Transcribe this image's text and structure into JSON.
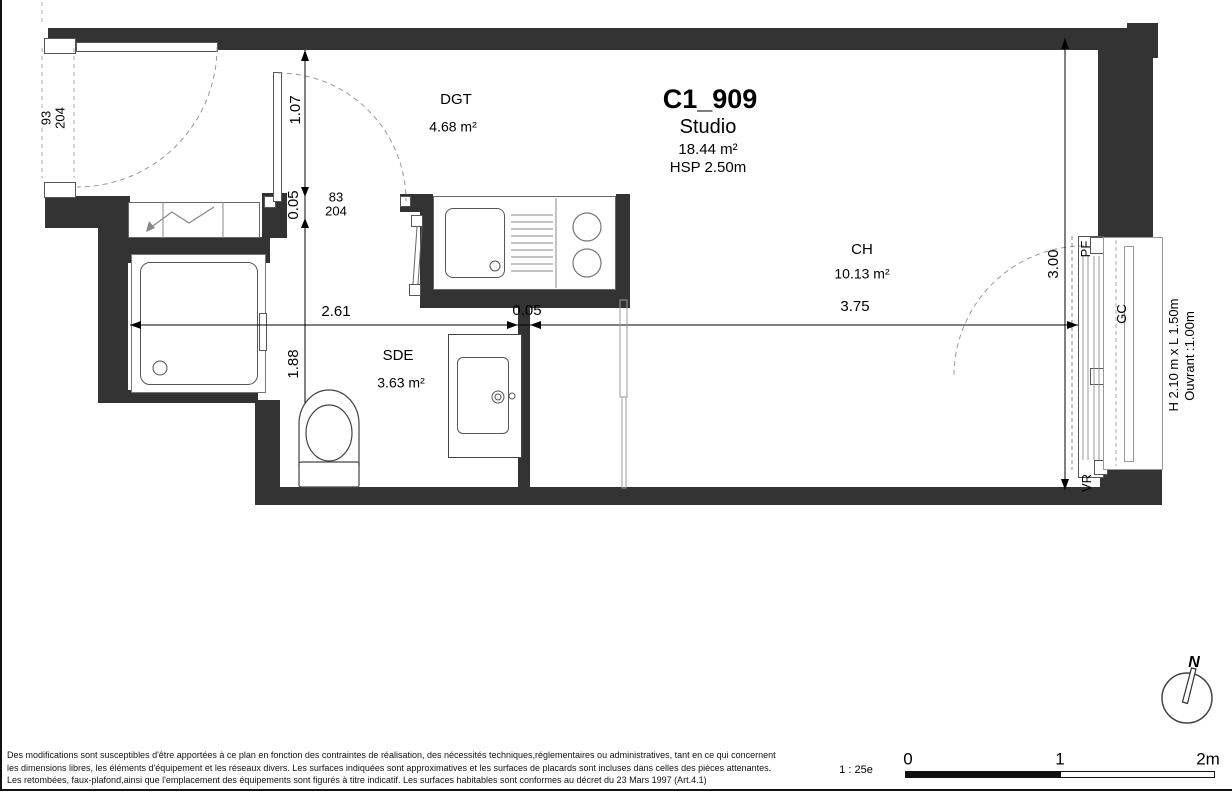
{
  "title_block": {
    "unit": "C1_909",
    "type": "Studio",
    "area": "18.44 m²",
    "height": "HSP 2.50m"
  },
  "rooms": {
    "dgt": {
      "name": "DGT",
      "area": "4.68 m²"
    },
    "ch": {
      "name": "CH",
      "area": "10.13 m²"
    },
    "sde": {
      "name": "SDE",
      "area": "3.63 m²"
    }
  },
  "doors": {
    "entrance": {
      "w": "93",
      "h": "204"
    },
    "interior": {
      "w": "83",
      "h": "204"
    }
  },
  "dims": {
    "w_left": "2.61",
    "w_wall": "0.05",
    "w_right": "3.75",
    "h_top": "1.07",
    "h_wall": "0.05",
    "h_bottom": "1.88",
    "h_right": "3.00"
  },
  "window": {
    "pf": "PF",
    "gc": "GC",
    "vr": "VR",
    "size": "H 2.10 m x L 1.50m",
    "opening": "Ouvrant :1.00m"
  },
  "scale_bar": {
    "ratio": "1 : 25e",
    "t0": "0",
    "t1": "1",
    "t2": "2m"
  },
  "north": {
    "label": "N"
  },
  "disclaimer": {
    "line1": "Des modifications sont susceptibles d'être apportées à ce plan en fonction des contraintes de réalisation, des nécessités techniques,réglementaires ou administratives, tant en ce qui concernent",
    "line2": "les dimensions libres, les éléments d'équipement et les réseaux divers. Les surfaces indiquées sont approximatives et les surfaces de placards sont incluses dans celles des pièces attenantes.",
    "line3": "Les retombées, faux-plafond,ainsi que l'emplacement des équipements sont figurés à titre indicatif. Les surfaces habitables sont conformes au décret du 23 Mars 1997 (Art.4.1)"
  },
  "colors": {
    "wall": "#333333",
    "line": "#000000"
  }
}
